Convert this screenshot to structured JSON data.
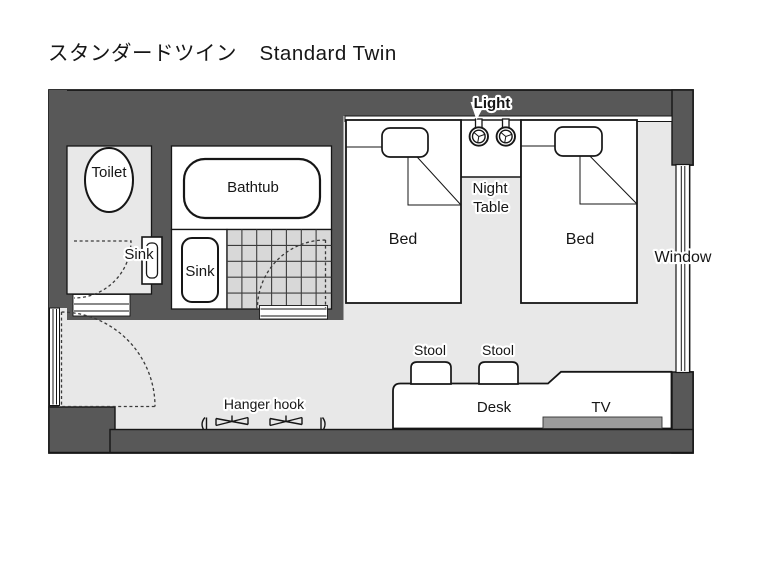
{
  "title": {
    "ja": "スタンダードツイン",
    "en": "Standard Twin"
  },
  "colors": {
    "wall": "#585858",
    "floor": "#e8e8e8",
    "tile": "#d8d8d8",
    "tv": "#9c9c9c"
  },
  "labels": {
    "toilet": "Toilet",
    "toilet_sink": "Sink",
    "bathtub": "Bathtub",
    "bath_sink": "Sink",
    "bed_left": "Bed",
    "bed_right": "Bed",
    "night_table_line1": "Night",
    "night_table_line2": "Table",
    "light": "Light",
    "window": "Window",
    "stool_left": "Stool",
    "stool_right": "Stool",
    "desk": "Desk",
    "tv": "TV",
    "hanger_hook": "Hanger hook"
  }
}
